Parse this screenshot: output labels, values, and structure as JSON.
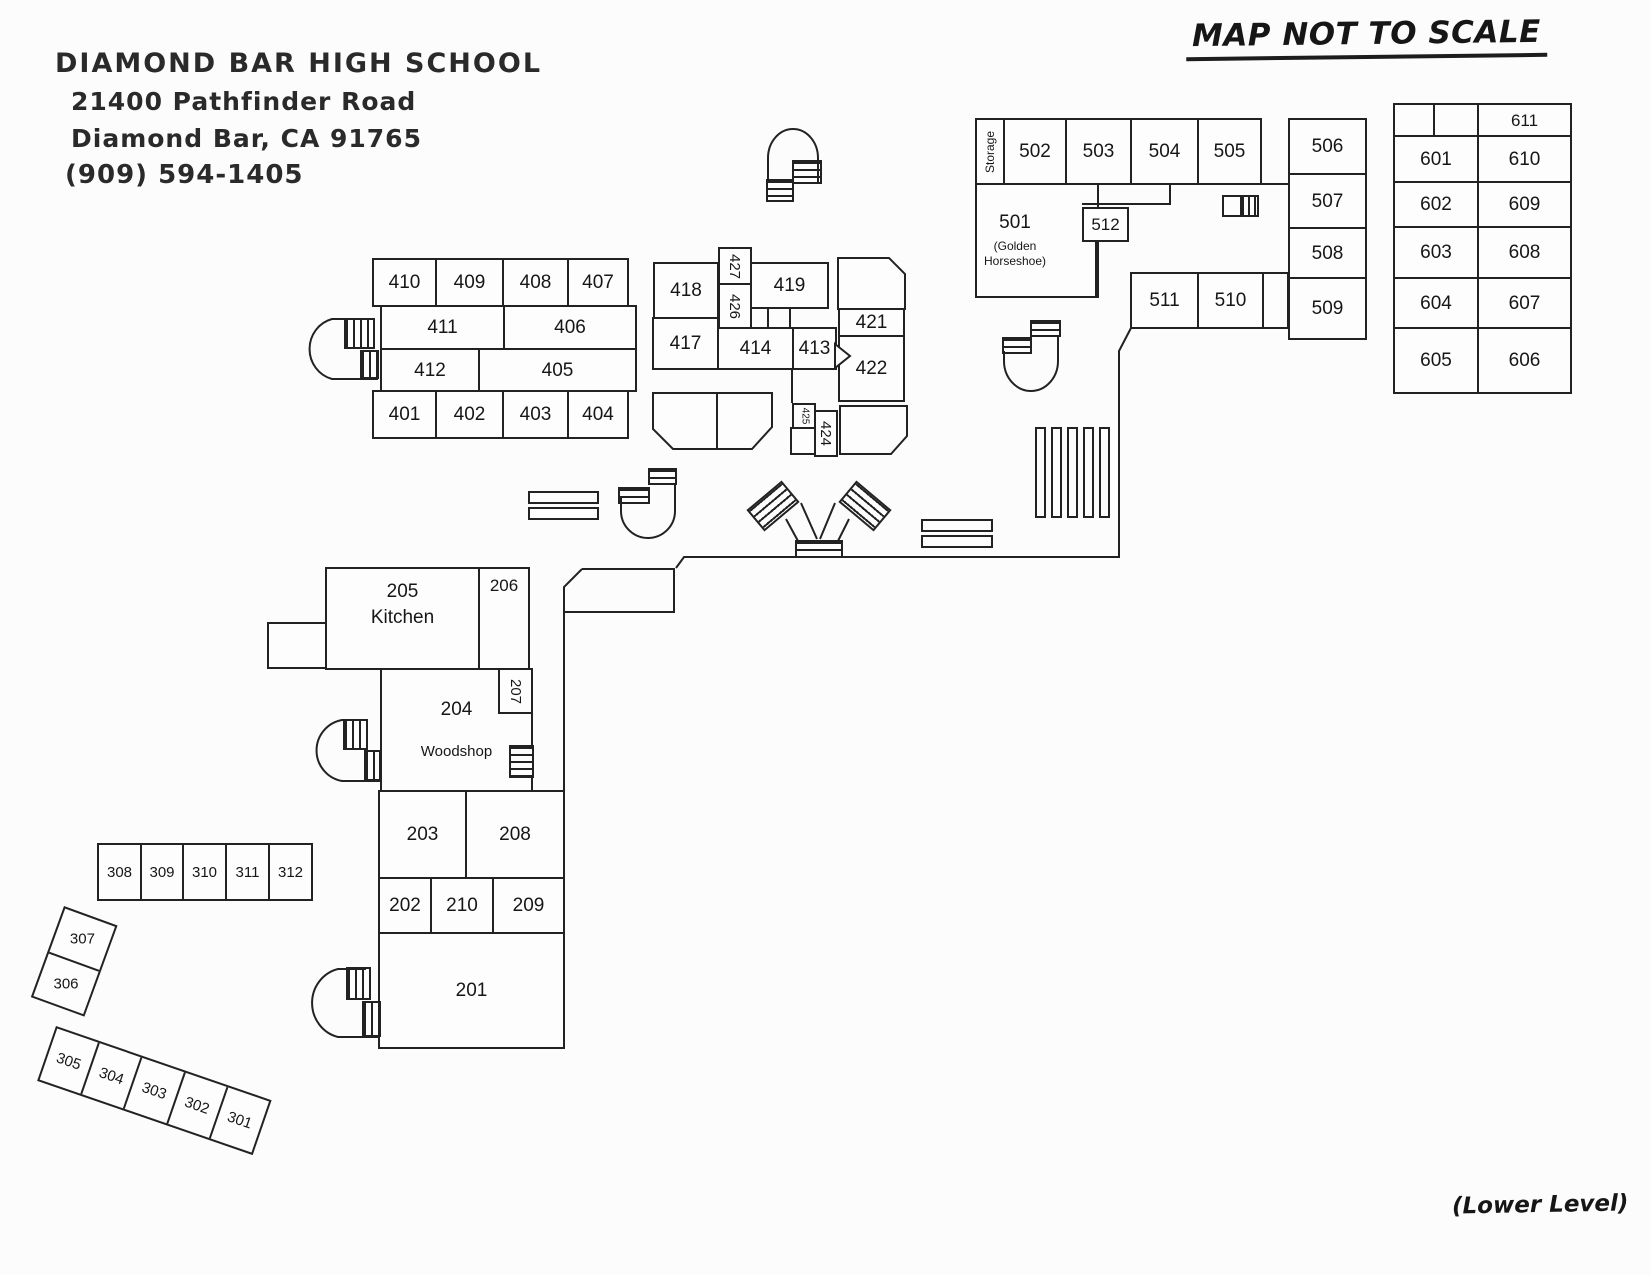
{
  "header": {
    "school_name": "DIAMOND BAR HIGH SCHOOL",
    "address_line1": "21400 Pathfinder Road",
    "address_line2": "Diamond Bar, CA 91765",
    "phone": "(909) 594-1405"
  },
  "map_title": "MAP NOT TO SCALE",
  "level_note": "(Lower Level)",
  "rooms": {
    "r201": "201",
    "r202": "202",
    "r203": "203",
    "r204": "204",
    "r204_sub": "Woodshop",
    "r205": "205",
    "r205_sub": "Kitchen",
    "r206": "206",
    "r207": "207",
    "r208": "208",
    "r209": "209",
    "r210": "210",
    "r301": "301",
    "r302": "302",
    "r303": "303",
    "r304": "304",
    "r305": "305",
    "r306": "306",
    "r307": "307",
    "r308": "308",
    "r309": "309",
    "r310": "310",
    "r311": "311",
    "r312": "312",
    "r401": "401",
    "r402": "402",
    "r403": "403",
    "r404": "404",
    "r405": "405",
    "r406": "406",
    "r407": "407",
    "r408": "408",
    "r409": "409",
    "r410": "410",
    "r411": "411",
    "r412": "412",
    "r413": "413",
    "r414": "414",
    "r415": "415",
    "r416": "416",
    "r417": "417",
    "r418": "418",
    "r419": "419",
    "r420": "420",
    "r421": "421",
    "r422": "422",
    "r423": "423",
    "r424": "424",
    "r425": "425",
    "r426": "426",
    "r427": "427",
    "storage": "Storage",
    "r501": "501",
    "r501_sub": "(Golden Horseshoe)",
    "r502": "502",
    "r503": "503",
    "r504": "504",
    "r505": "505",
    "r506": "506",
    "r507": "507",
    "r508": "508",
    "r509": "509",
    "r510": "510",
    "r511": "511",
    "r512": "512",
    "r601": "601",
    "r602": "602",
    "r603": "603",
    "r604": "604",
    "r605": "605",
    "r606": "606",
    "r607": "607",
    "r608": "608",
    "r609": "609",
    "r610": "610",
    "r611": "611"
  }
}
